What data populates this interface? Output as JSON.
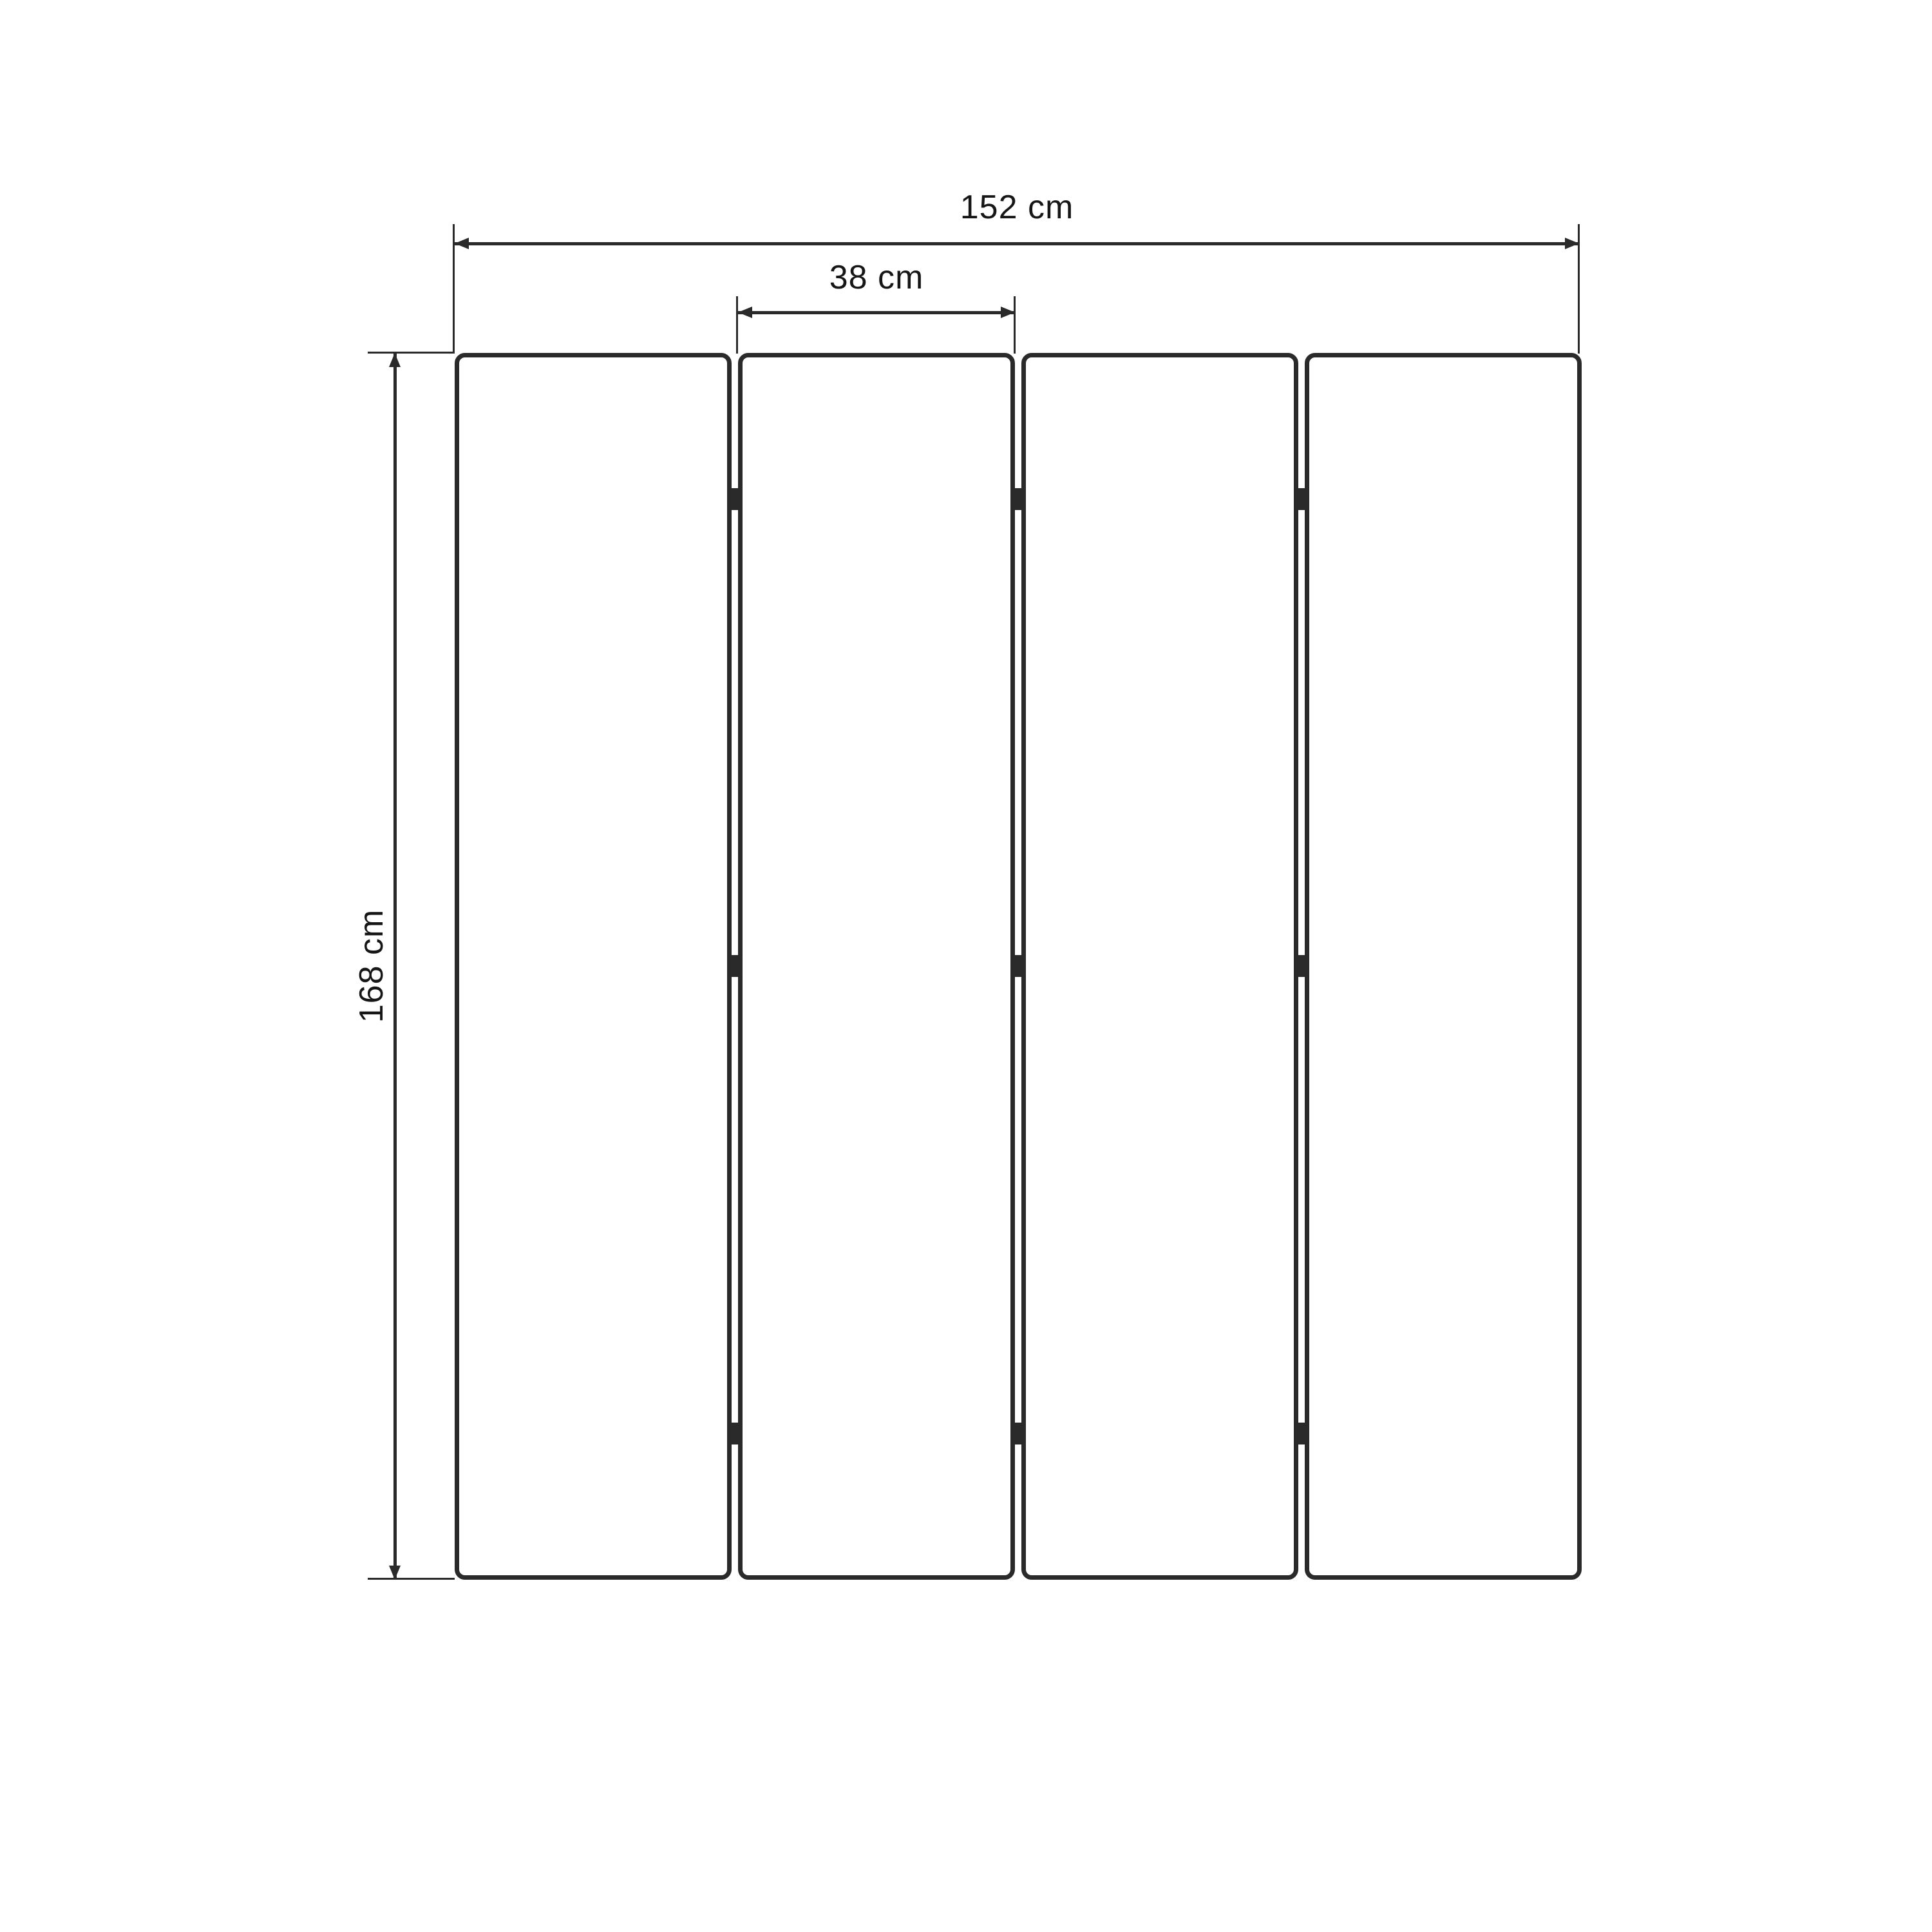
{
  "canvas": {
    "background": "#ffffff",
    "line_color": "#2a2a2a",
    "text_color": "#161616"
  },
  "figure": {
    "panels": {
      "count": 4,
      "hinge_rows_per_gap": 3
    },
    "dimensions": {
      "total_width_label": "152 cm",
      "panel_width_label": "38 cm",
      "height_label": "168 cm"
    }
  }
}
